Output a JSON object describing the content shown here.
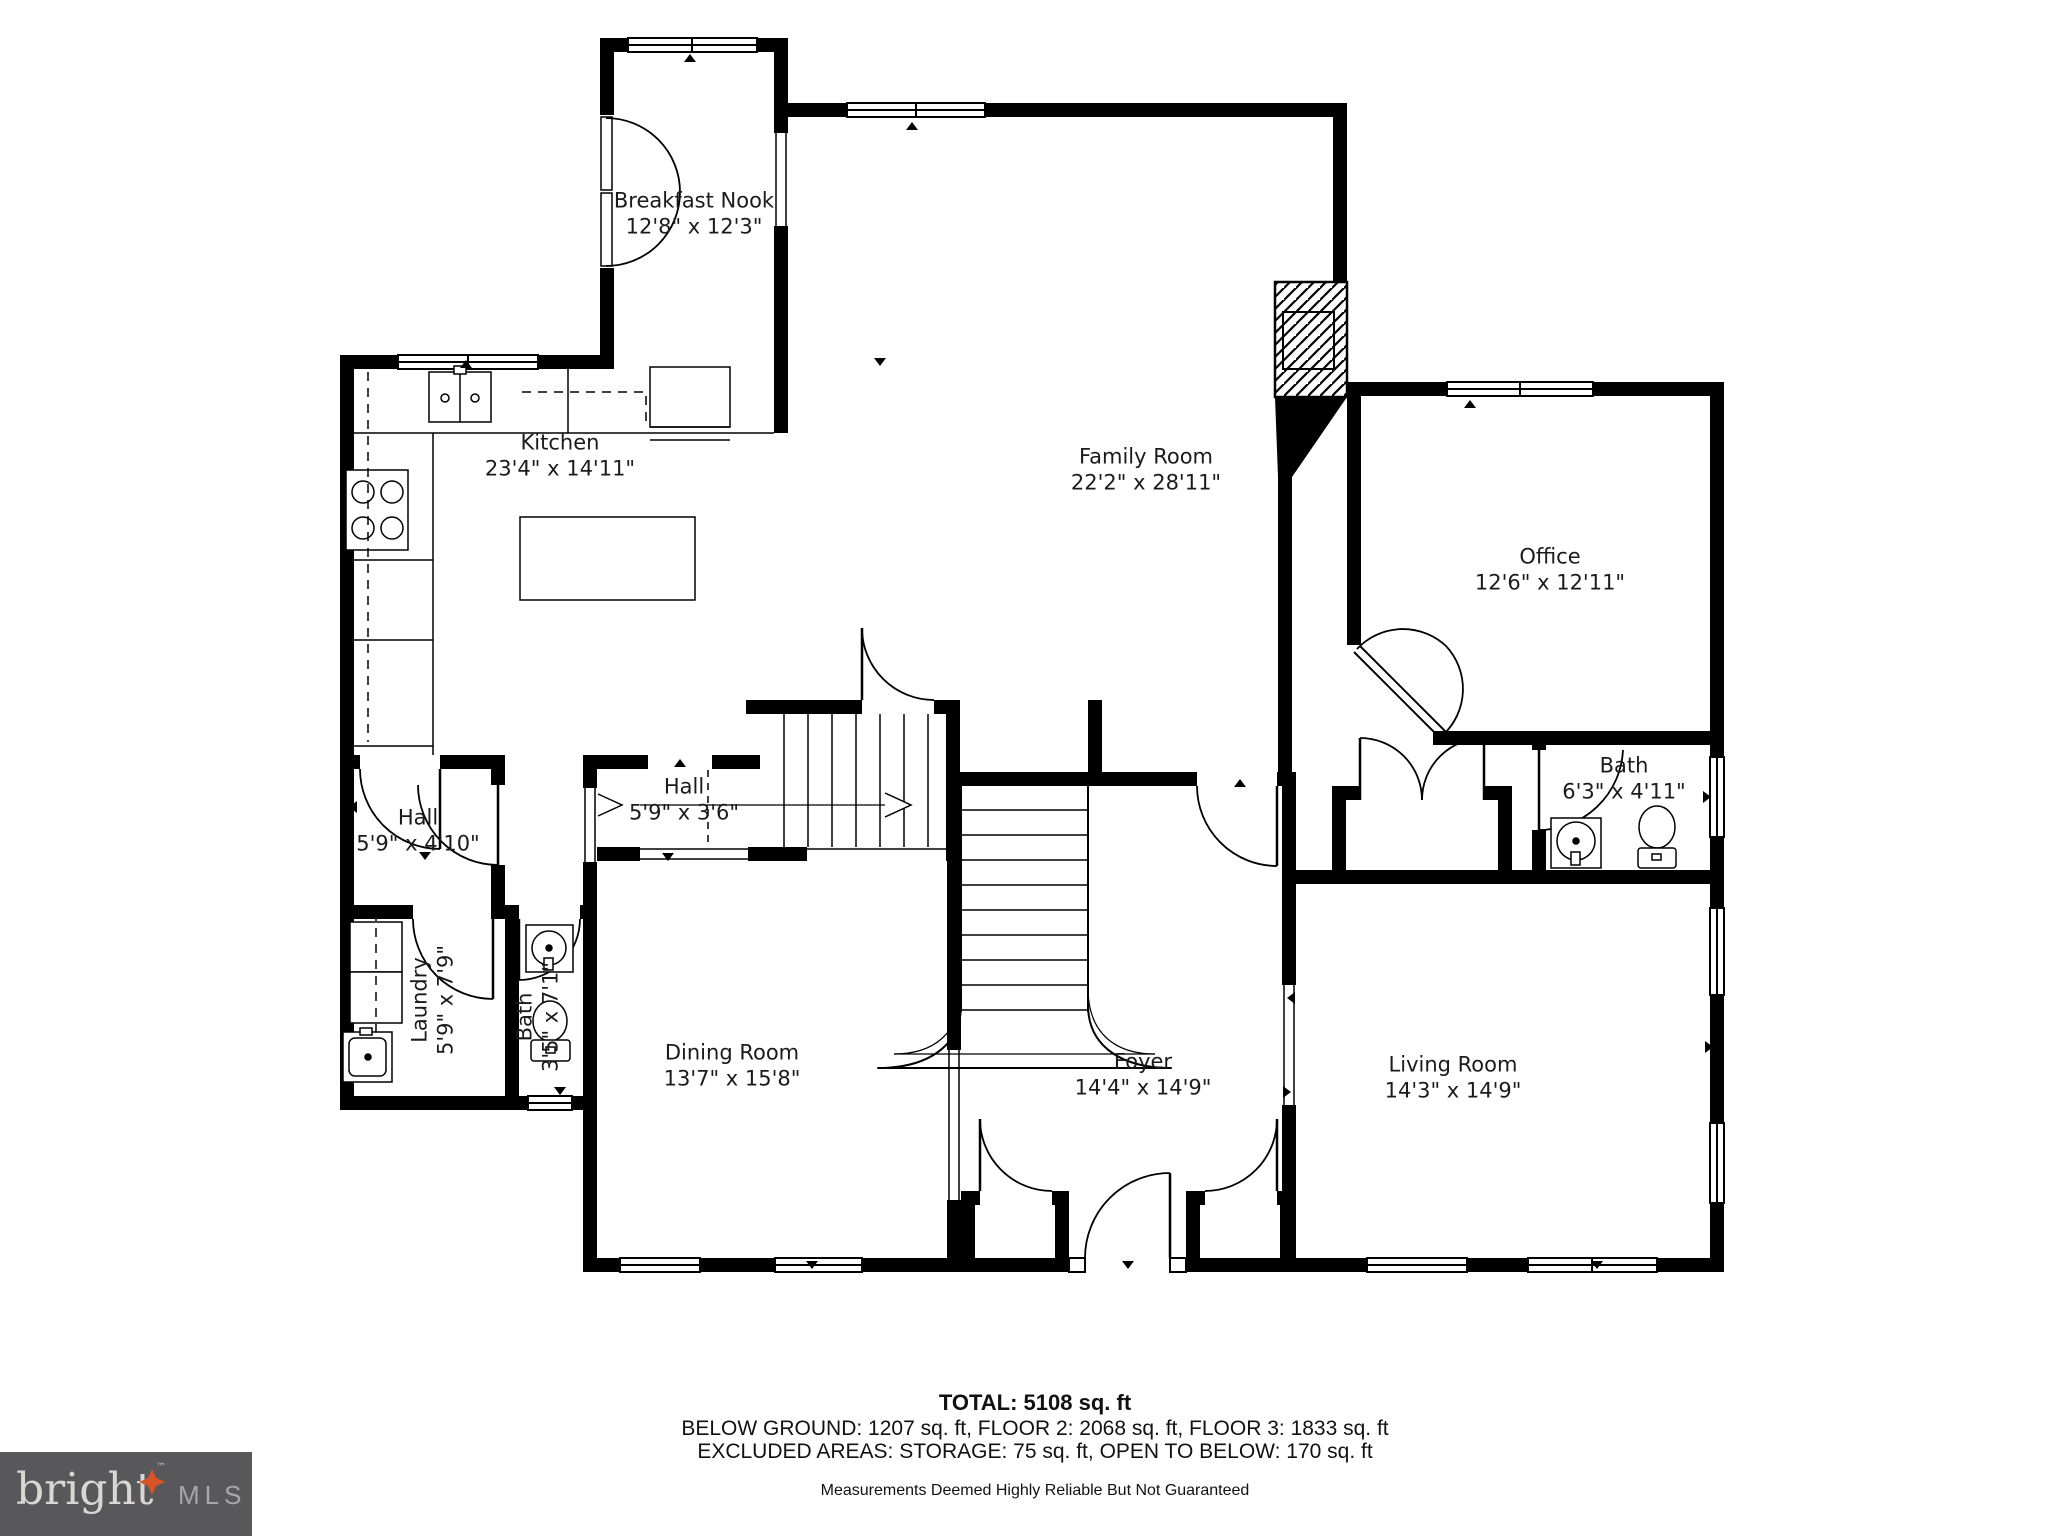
{
  "rooms": [
    {
      "name": "Breakfast Nook",
      "dims": "12'8\" x 12'3\""
    },
    {
      "name": "Kitchen",
      "dims": "23'4\" x 14'11\""
    },
    {
      "name": "Family Room",
      "dims": "22'2\" x 28'11\""
    },
    {
      "name": "Office",
      "dims": "12'6\" x 12'11\""
    },
    {
      "name": "Bath",
      "dims": "6'3\" x 4'11\""
    },
    {
      "name": "Hall",
      "dims": "5'9\" x 3'6\""
    },
    {
      "name": "Hall",
      "dims": "5'9\" x 4'10\""
    },
    {
      "name": "Laundry",
      "dims": "5'9\" x 7'9\""
    },
    {
      "name": "Bath",
      "dims": "3'5\" x 7'1\""
    },
    {
      "name": "Dining Room",
      "dims": "13'7\" x 15'8\""
    },
    {
      "name": "Foyer",
      "dims": "14'4\" x 14'9\""
    },
    {
      "name": "Living Room",
      "dims": "14'3\" x 14'9\""
    }
  ],
  "summary": {
    "total": "TOTAL: 5108 sq. ft",
    "floors": "BELOW GROUND: 1207 sq. ft, FLOOR 2: 2068 sq. ft, FLOOR 3: 1833 sq. ft",
    "excluded": "EXCLUDED AREAS: STORAGE: 75 sq. ft, OPEN TO BELOW: 170 sq. ft",
    "disclaimer": "Measurements Deemed Highly Reliable But Not Guaranteed"
  },
  "logo": {
    "brand": "bright",
    "tm": "™",
    "suffix": "MLS",
    "bg_color": "#58585a",
    "brand_color": "#d8d7d2",
    "suffix_color": "#a7a7a9",
    "star_color": "#d85427"
  }
}
